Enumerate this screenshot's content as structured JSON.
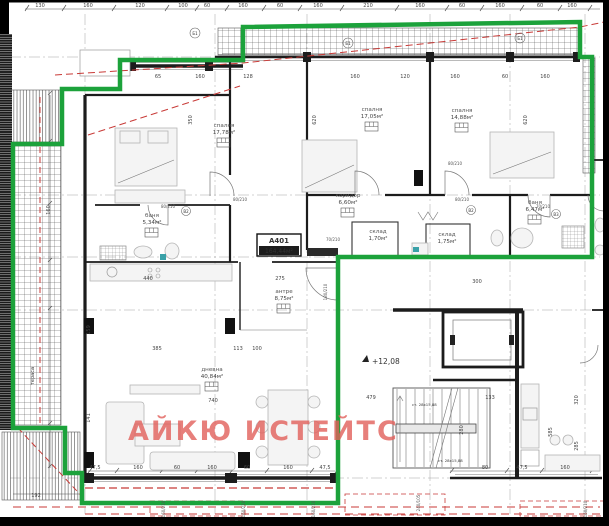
{
  "plan": {
    "watermark": "АЙКЮ ИСТЕЙТС",
    "apartment": {
      "code": "А401",
      "area": "164,44м²"
    },
    "level": "+12,08",
    "rooms": [
      {
        "name": "спалня",
        "area": "17,78м²"
      },
      {
        "name": "спалня",
        "area": "17,05м²"
      },
      {
        "name": "спалня",
        "area": "14,88м²"
      },
      {
        "name": "коридор",
        "area": "6,60м²"
      },
      {
        "name": "баня",
        "area": "5,34м²"
      },
      {
        "name": "баня",
        "area": "6,47м²"
      },
      {
        "name": "склад",
        "area": "1,70м²"
      },
      {
        "name": "склад",
        "area": "1,75м²"
      },
      {
        "name": "антре",
        "area": "8,75м²"
      },
      {
        "name": "дневна",
        "area": "40,84м²"
      }
    ],
    "stair_note": "ст. 28х15,88",
    "terrace_note": "тераса",
    "doors": [
      "80/210",
      "80/210",
      "80/210",
      "80/210",
      "70/210",
      "70/210",
      "180/210"
    ],
    "windows": [
      "160/210",
      "160/210",
      "160/210",
      "240/105",
      "160/210"
    ],
    "axis_marks": [
      "Б1",
      "Б1",
      "Б1",
      "В2",
      "В2",
      "В3"
    ],
    "dims": {
      "top": [
        "130",
        "160",
        "120",
        "100",
        "60",
        "160",
        "60",
        "160",
        "210",
        "160",
        "60",
        "160",
        "60",
        "160"
      ],
      "row2": [
        "65",
        "160",
        "128",
        "160",
        "120",
        "160",
        "60",
        "160"
      ],
      "bottom": [
        "47,5",
        "160",
        "60",
        "160",
        "60",
        "160",
        "47,5",
        "80",
        "47,5",
        "160"
      ],
      "misc": [
        "385",
        "740",
        "440",
        "275",
        "113",
        "100",
        "479",
        "133",
        "300",
        "192"
      ],
      "vert": [
        "620",
        "620",
        "350",
        "280",
        "320",
        "285",
        "585",
        "160",
        "141",
        "159"
      ]
    },
    "colors": {
      "boundary_green": "#1ca23b",
      "annotation_red": "#c83a37",
      "watermark_red": "#e2605b",
      "wall_black": "#1c1c1c"
    }
  }
}
